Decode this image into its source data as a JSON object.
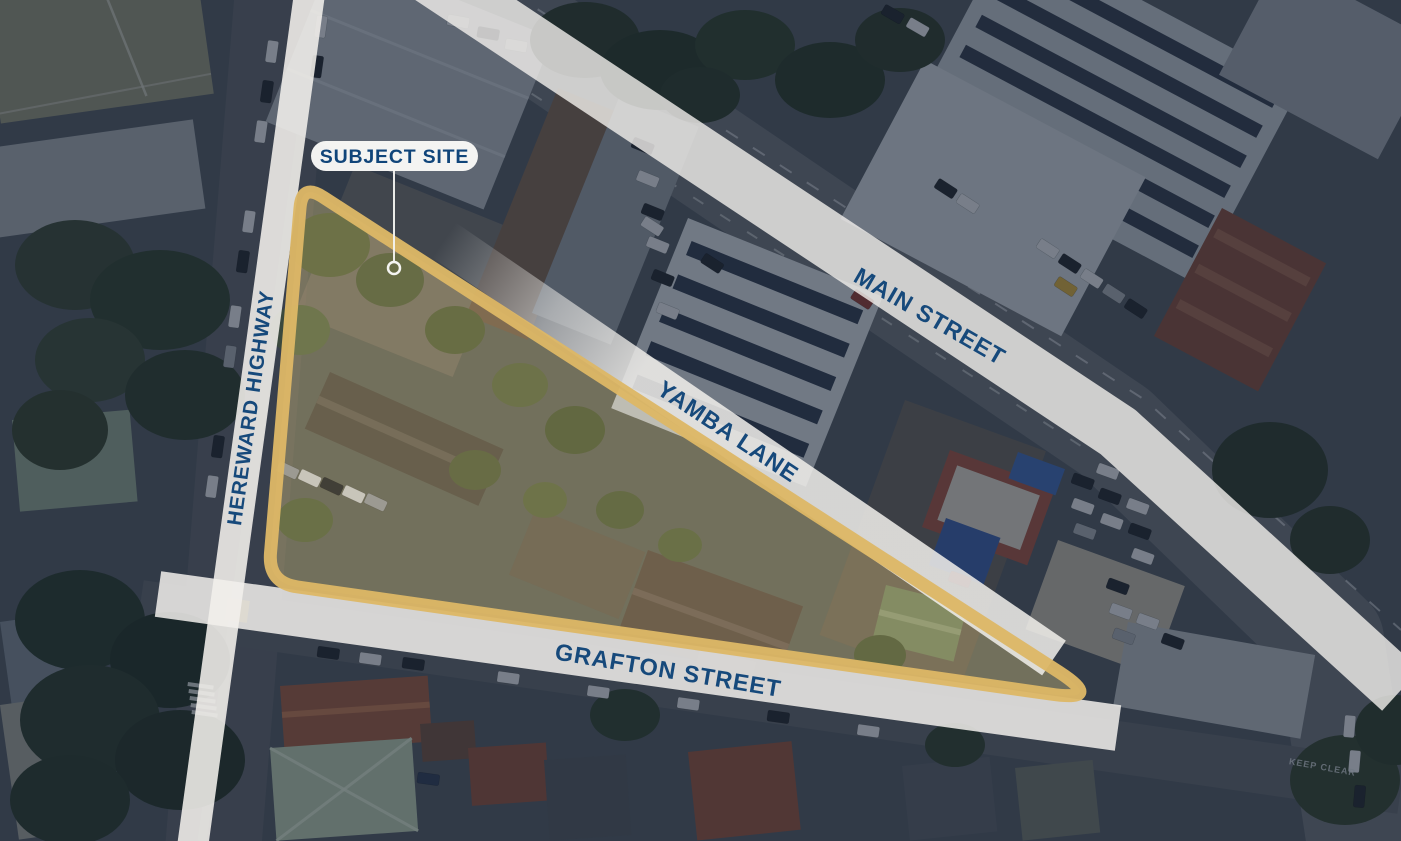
{
  "map": {
    "type": "aerial-site-context-map",
    "callout": {
      "label": "SUBJECT SITE"
    },
    "streets": {
      "hereward": "HEREWARD HIGHWAY",
      "main": "MAIN STREET",
      "yamba": "YAMBA LANE",
      "grafton": "GRAFTON STREET"
    },
    "road_marking": "KEEP CLEAR",
    "colors": {
      "boundary": "#DDB766",
      "street_label": "#16497B",
      "street_band": "#F2F0EC",
      "callout_text": "#10457A",
      "callout_pill": "#FAFAF8",
      "overlay": "rgba(15,26,46,0.42)",
      "site_tint": "rgba(224,186,100,0.16)"
    }
  }
}
